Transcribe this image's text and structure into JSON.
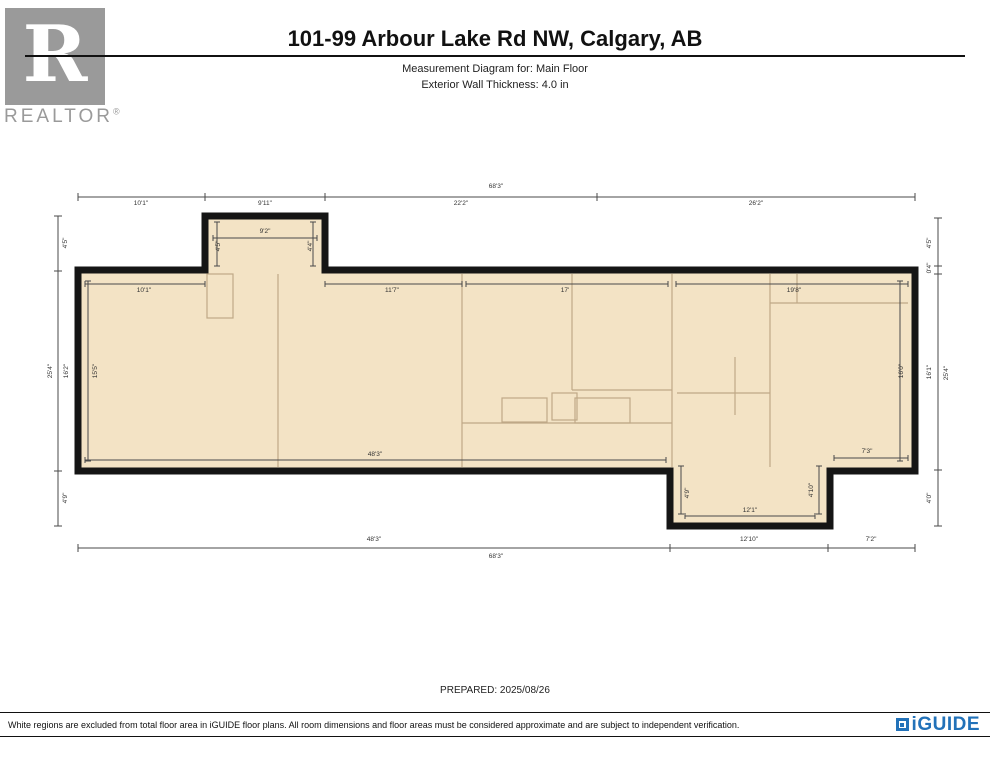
{
  "header": {
    "title": "101-99 Arbour Lake Rd NW, Calgary, AB",
    "subtitle1": "Measurement Diagram for: Main Floor",
    "subtitle2": "Exterior Wall Thickness: 4.0 in",
    "realtor_letter": "R",
    "realtor_label": "REALTOR"
  },
  "plan": {
    "floor_name": "Main Floor",
    "wall_color": "#151515",
    "floor_fill_color": "#f3e3c5",
    "interior_line_color": "#bfa887",
    "dimension_line_color": "#4a4a4a",
    "exterior_overall_width": "68'3\"",
    "exterior_overall_height": "25'4\"",
    "labels": [
      {
        "t": "68'3\"",
        "x": 496,
        "y": 187
      },
      {
        "t": "10'1\"",
        "x": 141,
        "y": 204
      },
      {
        "t": "9'11\"",
        "x": 265,
        "y": 204
      },
      {
        "t": "22'2\"",
        "x": 461,
        "y": 204
      },
      {
        "t": "26'2\"",
        "x": 756,
        "y": 204
      },
      {
        "t": "9'2\"",
        "x": 265,
        "y": 232
      },
      {
        "t": "4'5\"",
        "x": 219,
        "y": 246,
        "v": 1
      },
      {
        "t": "4'4\"",
        "x": 311,
        "y": 246,
        "v": 1
      },
      {
        "t": "10'1\"",
        "x": 144,
        "y": 291
      },
      {
        "t": "11'7\"",
        "x": 392,
        "y": 291
      },
      {
        "t": "17'",
        "x": 565,
        "y": 291
      },
      {
        "t": "19'8\"",
        "x": 794,
        "y": 291
      },
      {
        "t": "15'5\"",
        "x": 96,
        "y": 371,
        "v": 1
      },
      {
        "t": "16'0\"",
        "x": 902,
        "y": 371,
        "v": 1
      },
      {
        "t": "48'3\"",
        "x": 375,
        "y": 455
      },
      {
        "t": "7'3\"",
        "x": 867,
        "y": 452
      },
      {
        "t": "4'9\"",
        "x": 688,
        "y": 493,
        "v": 1
      },
      {
        "t": "4'10\"",
        "x": 812,
        "y": 490,
        "v": 1
      },
      {
        "t": "12'1\"",
        "x": 750,
        "y": 511
      },
      {
        "t": "48'3\"",
        "x": 374,
        "y": 540
      },
      {
        "t": "12'10\"",
        "x": 749,
        "y": 540
      },
      {
        "t": "7'2\"",
        "x": 871,
        "y": 540
      },
      {
        "t": "68'3\"",
        "x": 496,
        "y": 557
      },
      {
        "t": "4'5\"",
        "x": 66,
        "y": 243,
        "v": 1
      },
      {
        "t": "25'4\"",
        "x": 51,
        "y": 371,
        "v": 1
      },
      {
        "t": "16'2\"",
        "x": 67,
        "y": 371,
        "v": 1
      },
      {
        "t": "4'9\"",
        "x": 66,
        "y": 498,
        "v": 1
      },
      {
        "t": "4'5\"",
        "x": 930,
        "y": 243,
        "v": 1
      },
      {
        "t": "0'4\"",
        "x": 930,
        "y": 268,
        "v": 1
      },
      {
        "t": "16'1\"",
        "x": 930,
        "y": 372,
        "v": 1
      },
      {
        "t": "25'4\"",
        "x": 947,
        "y": 373,
        "v": 1
      },
      {
        "t": "4'0\"",
        "x": 930,
        "y": 498,
        "v": 1
      }
    ]
  },
  "footer": {
    "prepared": "PREPARED: 2025/08/26",
    "disclaimer": "White regions are excluded from total floor area in iGUIDE floor plans. All room dimensions and floor areas must be considered approximate and are subject to independent verification.",
    "brand": "iGUIDE",
    "brand_color": "#2272b9"
  }
}
